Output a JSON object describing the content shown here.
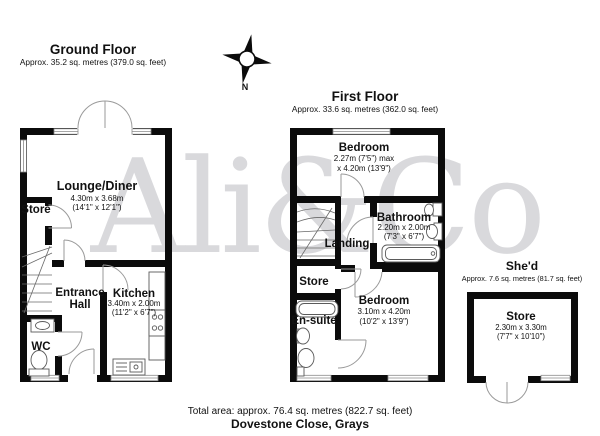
{
  "watermark": {
    "text": "Ali&Co"
  },
  "compass": {
    "label": "N"
  },
  "ground_floor": {
    "title": "Ground Floor",
    "area": "Approx. 35.2 sq. metres (379.0 sq. feet)",
    "rooms": {
      "lounge": {
        "name": "Lounge/Diner",
        "dim_metric": "4.30m x 3.68m",
        "dim_imperial": "(14'1\" x 12'1\")"
      },
      "store": {
        "name": "Store"
      },
      "entrance_hall": {
        "line1": "Entrance",
        "line2": "Hall"
      },
      "kitchen": {
        "name": "Kitchen",
        "dim_metric": "3.40m x 2.00m",
        "dim_imperial": "(11'2\" x 6'7\")"
      },
      "wc": {
        "name": "WC"
      }
    }
  },
  "first_floor": {
    "title": "First Floor",
    "area": "Approx. 33.6 sq. metres (362.0 sq. feet)",
    "rooms": {
      "bedroom1": {
        "name": "Bedroom",
        "dim_line1": "2.27m (7'5\") max",
        "dim_line2": "x 4.20m (13'9\")"
      },
      "bathroom": {
        "name": "Bathroom",
        "dim_metric": "2.20m x 2.00m",
        "dim_imperial": "(7'3\" x 6'7\")"
      },
      "landing": {
        "name": "Landing"
      },
      "store": {
        "name": "Store"
      },
      "ensuite": {
        "name": "En-suite"
      },
      "bedroom2": {
        "name": "Bedroom",
        "dim_metric": "3.10m x 4.20m",
        "dim_imperial": "(10'2\" x 13'9\")"
      }
    }
  },
  "shed": {
    "title": "She'd",
    "area": "Approx. 7.6 sq. metres (81.7 sq. feet)",
    "rooms": {
      "store": {
        "name": "Store",
        "dim_metric": "2.30m x 3.30m",
        "dim_imperial": "(7'7\" x 10'10\")"
      }
    }
  },
  "footer": {
    "total_area": "Total area: approx. 76.4 sq. metres (822.7 sq. feet)",
    "address": "Dovestone Close, Grays"
  }
}
